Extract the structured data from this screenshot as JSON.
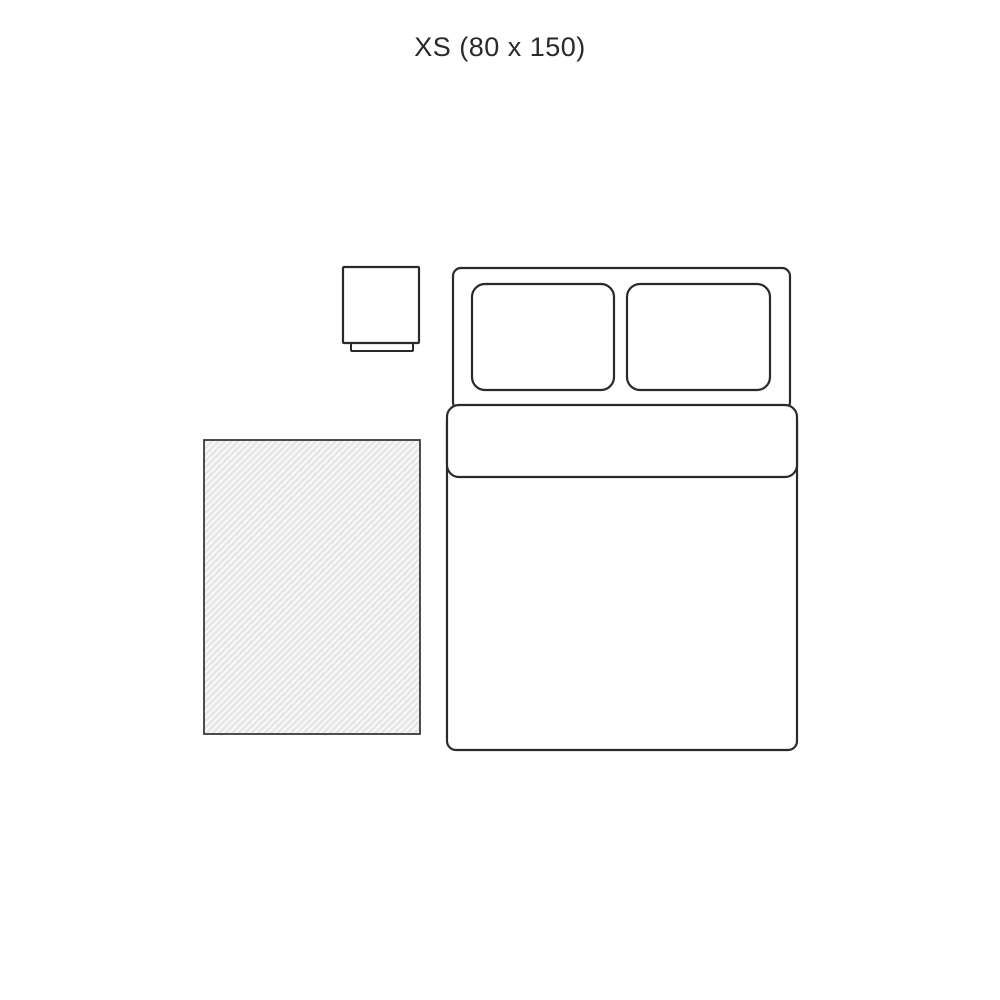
{
  "title": "XS (80 x 150)",
  "size": {
    "label": "XS",
    "dimensions": "80 x 150"
  },
  "colors": {
    "background": "#ffffff",
    "line": "#2a2a2a",
    "rug_fill": "#e7e7e7",
    "rug_hatch": "#fbfbfb",
    "rug_border": "#3a3a3a"
  }
}
